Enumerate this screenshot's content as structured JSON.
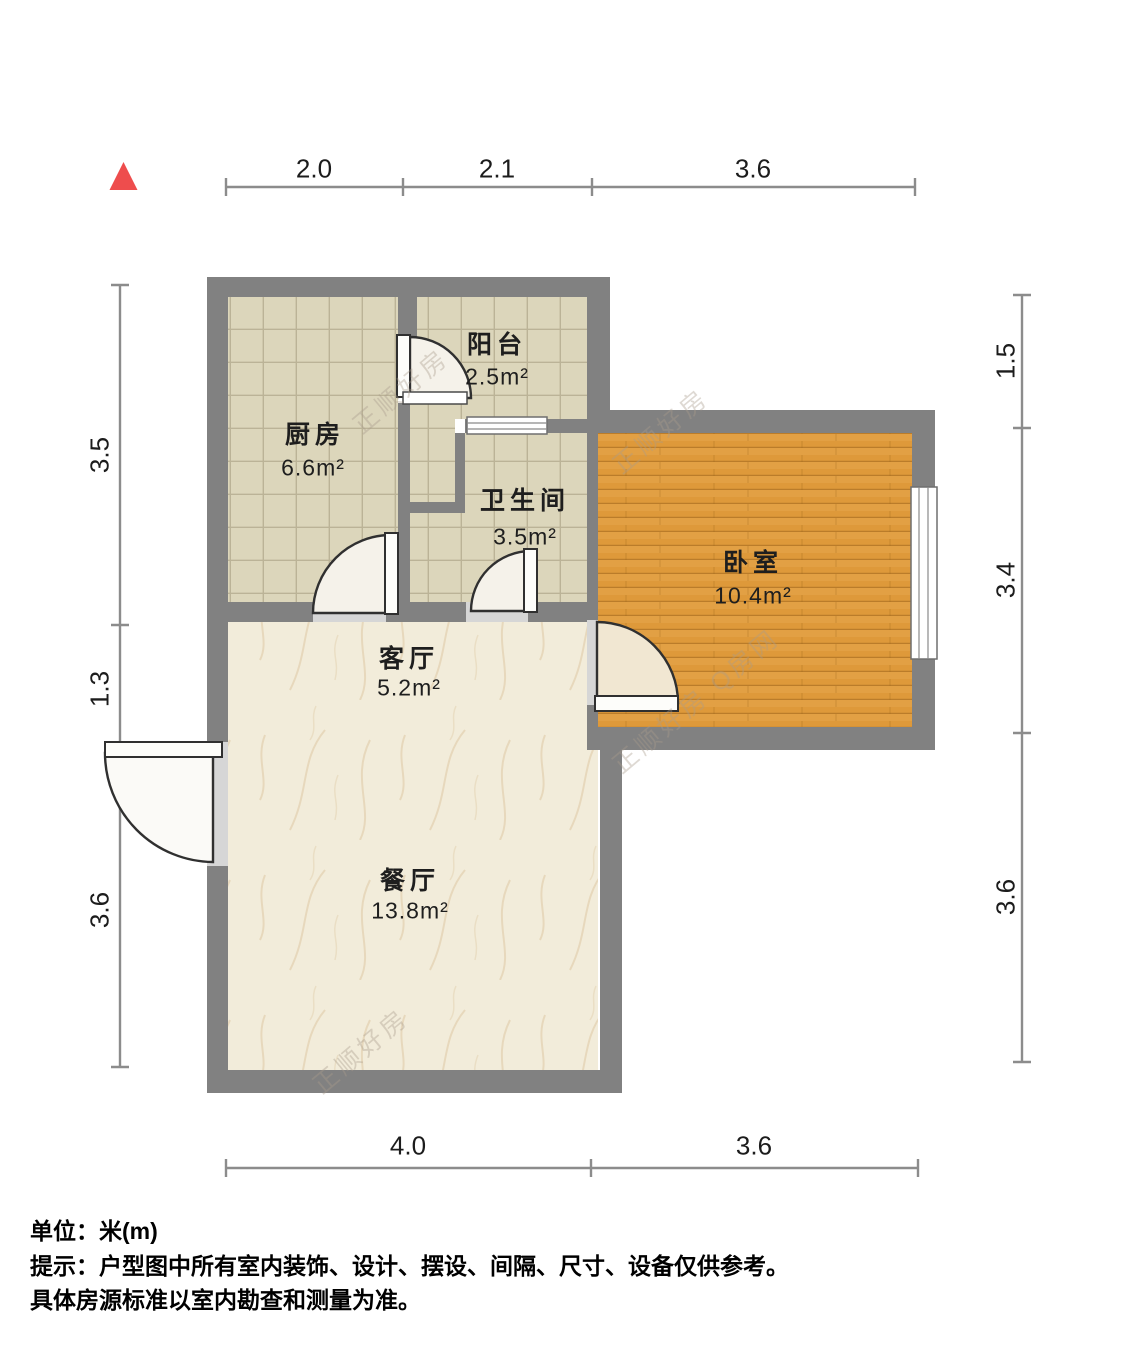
{
  "plan": {
    "title": "户型图",
    "unit_label": "米(m)"
  },
  "rooms": [
    {
      "name": "厨房",
      "area": "6.6m²"
    },
    {
      "name": "阳台",
      "area": "2.5m²"
    },
    {
      "name": "卫生间",
      "area": "3.5m²"
    },
    {
      "name": "卧室",
      "area": "10.4m²"
    },
    {
      "name": "客厅",
      "area": "5.2m²"
    },
    {
      "name": "餐厅",
      "area": "13.8m²"
    }
  ],
  "dimensions": {
    "top": [
      "2.0",
      "2.1",
      "3.6"
    ],
    "bottom": [
      "4.0",
      "3.6"
    ],
    "left": [
      "3.5",
      "1.3",
      "3.6"
    ],
    "right": [
      "1.5",
      "3.4",
      "3.6"
    ]
  },
  "notes": {
    "unit": "单位：米(m)",
    "tip_line1": "提示：户型图中所有室内装饰、设计、摆设、间隔、尺寸、设备仅供参考。",
    "tip_line2": "具体房源标准以室内勘查和测量为准。"
  },
  "watermarks": [
    "正顺好房",
    "正顺好房",
    "正顺好房 Q房网",
    "正顺好房"
  ],
  "palette": {
    "wall": "#818181",
    "tile_floor": "#dcd6bb",
    "wood_floor": "#e2a044",
    "marble_floor": "#f2ecda",
    "door_opening": "#d6d6d6",
    "north_arrow": "#ee4d4d",
    "dimension_line": "#8c8c8c",
    "text": "#1e1e1e"
  }
}
